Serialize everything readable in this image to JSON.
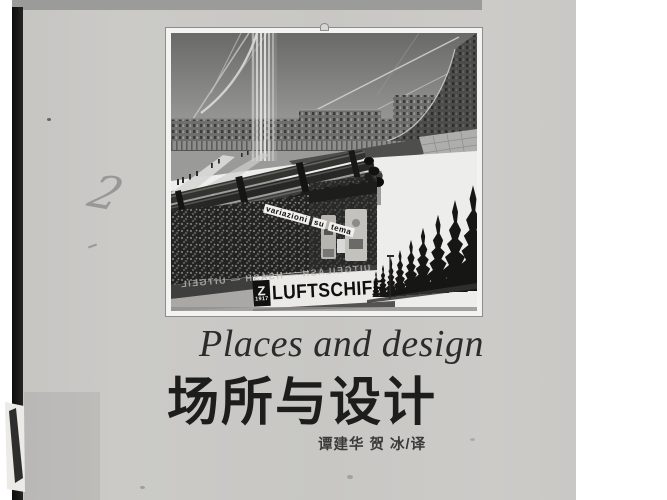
{
  "page": {
    "kind": "scanned book cover",
    "colors": {
      "page_gray": "#c9c8c5",
      "top_band": "#9b9b99",
      "spine_black": "#161616",
      "margin_white": "#ffffff"
    }
  },
  "cover": {
    "title_en": "Places and design",
    "title_zh": "场所与设计",
    "translators": "谭建华 贺 冰/译"
  },
  "illustration": {
    "description": "black-and-white futurist architectural drawing: curved crescent of buildings, cables, pipes, billboard kiosk with crowd image, cypress trees",
    "texts": {
      "banner_words": [
        "variazioni",
        "su",
        "tema"
      ],
      "mirrored_band": "UITGEILASH — HSASH — UITGEIL",
      "sign_z": "Z",
      "sign_year": "1917",
      "sign_main": "LUFTSCHIFF"
    }
  },
  "annotations": {
    "handwritten_mark": "2"
  }
}
